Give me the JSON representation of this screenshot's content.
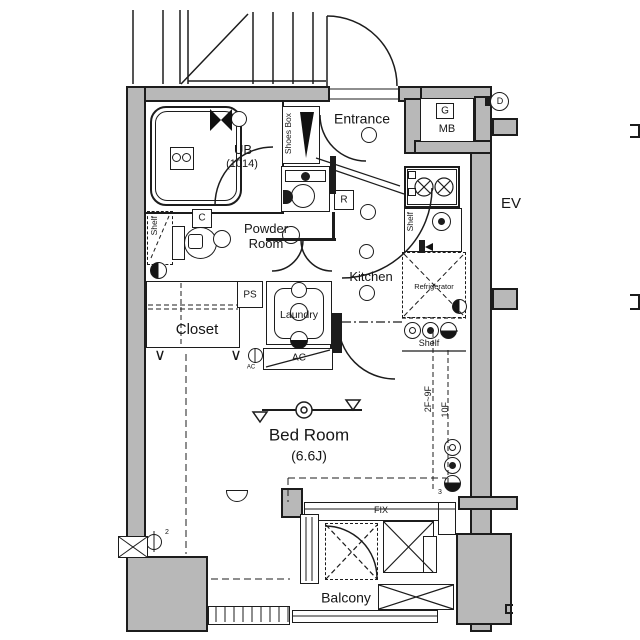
{
  "title": "apartment-floor-plan",
  "rooms": {
    "ub": {
      "name": "UB",
      "size": "(1014)"
    },
    "powder": {
      "line1": "Powder",
      "line2": "Room"
    },
    "entrance": {
      "name": "Entrance"
    },
    "kitchen": {
      "name": "Kitchen"
    },
    "closet": {
      "name": "Closet"
    },
    "laundry": {
      "name": "Laundry"
    },
    "bedroom": {
      "name": "Bed Room",
      "size": "(6.6J)"
    },
    "balcony": {
      "name": "Balcony"
    },
    "elevator": {
      "name": "EV"
    }
  },
  "fixtures": {
    "shoes_box": "Shoes Box",
    "shelf": "Shelf",
    "ps": "PS",
    "ac": "AC",
    "ac_outdoor": "AC",
    "refrigerator": "Refrigerator",
    "fix_window": "FIX",
    "hanger_mark": "∨"
  },
  "tags": {
    "c": "C",
    "r": "R",
    "g": "G",
    "mb": "MB",
    "d": "D"
  },
  "annotations": {
    "floors_low": "2F~9F",
    "floors_high": "10F",
    "outlet_count_2": "2",
    "outlet_count_3": "3"
  },
  "colors": {
    "wall_fill": "#b8b8b8",
    "line": "#1c1c1c",
    "background": "#ffffff"
  }
}
